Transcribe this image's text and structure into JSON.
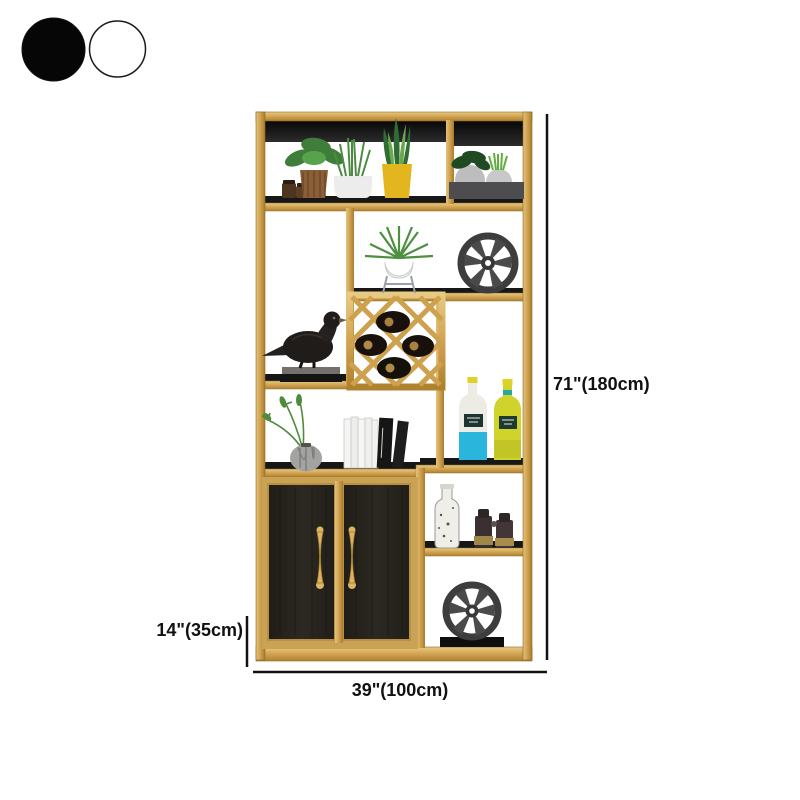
{
  "color_options": {
    "items": [
      {
        "name": "black",
        "hex": "#060606",
        "selected": true
      },
      {
        "name": "white",
        "hex": "#ffffff",
        "selected": false
      }
    ]
  },
  "dimensions": {
    "height_label": "71\"(180cm)",
    "base_height_label": "14\"(35cm)",
    "width_label": "39\"(100cm)"
  },
  "product": {
    "type": "gold-frame-display-shelf-with-cabinet",
    "frame_color": "#d1a352",
    "shelf_color": "#1b1b1b",
    "cabinet_door_color": "#28251f",
    "decor_items": [
      "potted-plant-brown-pot",
      "spice-jars",
      "grass-plant-white-pot",
      "snake-plant-yellow-pot",
      "planter-box-two-pots",
      "air-plant-on-stand",
      "wagon-wheel-top",
      "bird-figurine-on-books",
      "wine-rack-with-bottles",
      "fern-sprigs-gray-vase",
      "book-stack",
      "cyan-bottle",
      "yellow-bottle",
      "speckled-ceramic-bottle",
      "binoculars",
      "wagon-wheel-bottom"
    ]
  }
}
